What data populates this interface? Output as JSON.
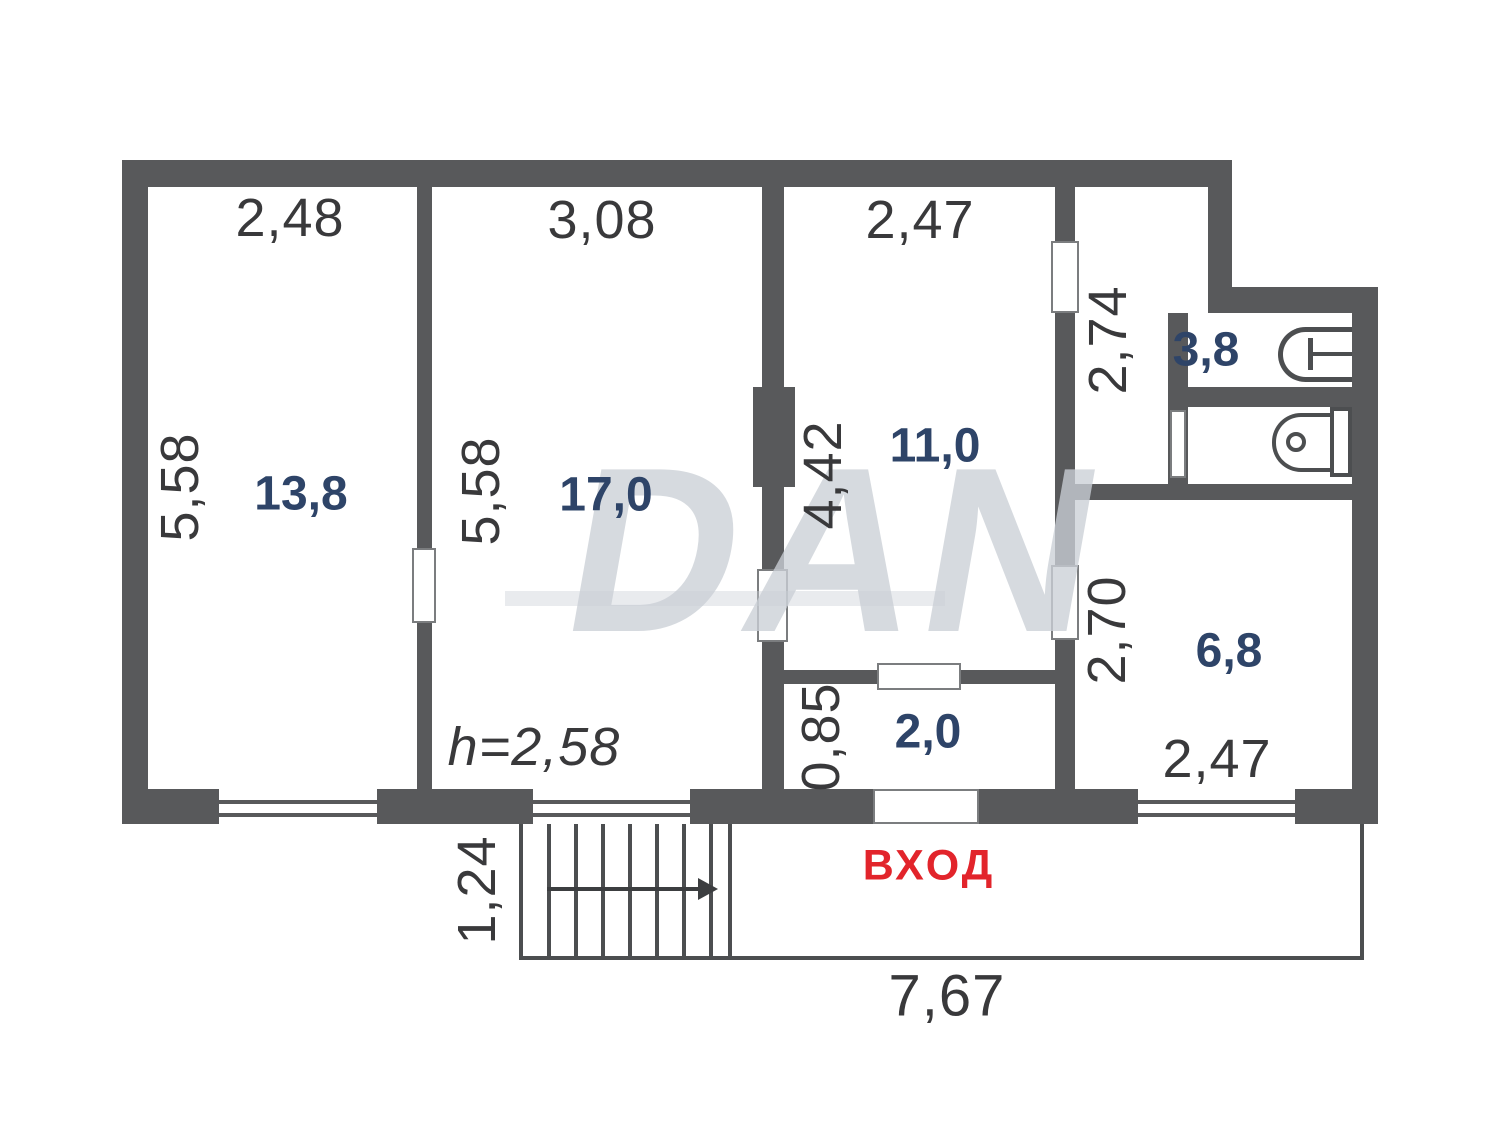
{
  "watermark": {
    "text": "DAN"
  },
  "plan": {
    "entrance_label": "ВХОД",
    "rooms": [
      {
        "name": "room-13-8",
        "area_label": "13,8",
        "width_label": "2,48",
        "height_label": "5,58"
      },
      {
        "name": "room-17-0",
        "area_label": "17,0",
        "width_label": "3,08",
        "height_label": "5,58",
        "ceiling_height_label": "h=2,58"
      },
      {
        "name": "room-11-0",
        "area_label": "11,0",
        "width_label": "2,47",
        "height_label": "4,42"
      },
      {
        "name": "bathroom-3-8",
        "area_label": "3,8",
        "height_label": "2,74"
      },
      {
        "name": "room-6-8",
        "area_label": "6,8",
        "height_label": "2,70",
        "width_label": "2,47"
      },
      {
        "name": "hall-2-0",
        "area_label": "2,0",
        "height_label": "0,85"
      }
    ],
    "porch": {
      "height_label": "1,24",
      "width_label": "7,67"
    }
  },
  "colors": {
    "wall": "#58595b",
    "area_text": "#2e4468",
    "dimension_text": "#39393b",
    "entrance_text": "#e2242b"
  }
}
